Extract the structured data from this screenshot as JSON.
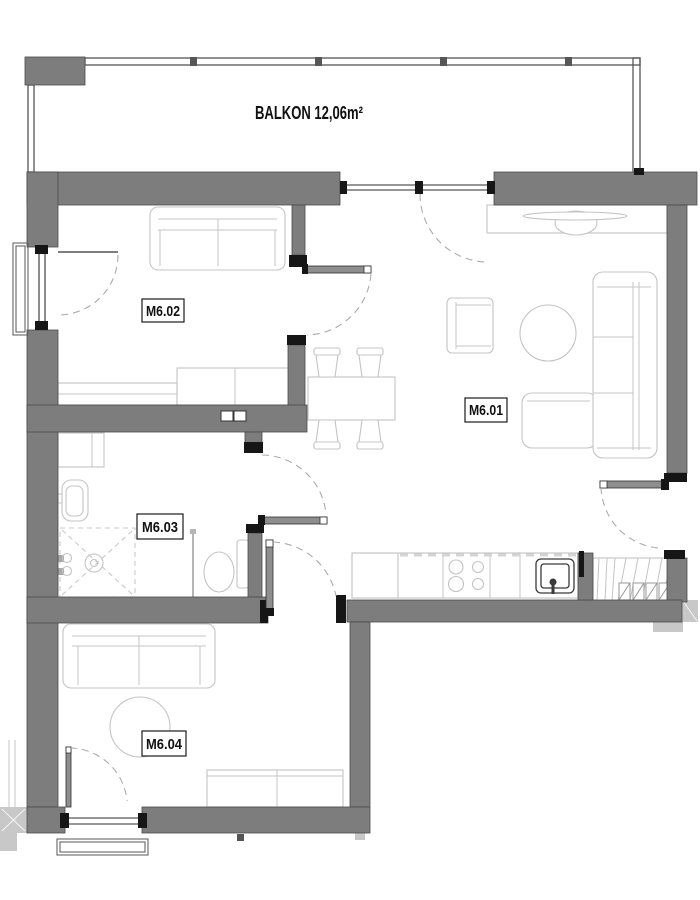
{
  "floorplan": {
    "balcony": {
      "label": "BALKON 12,06m²"
    },
    "rooms": [
      {
        "id": "room-m601",
        "label": "M6.01"
      },
      {
        "id": "room-m602",
        "label": "M6.02"
      },
      {
        "id": "room-m603",
        "label": "M6.03"
      },
      {
        "id": "room-m604",
        "label": "M6.04"
      }
    ],
    "colors": {
      "bg": "#ffffff",
      "wall": "#7d7d7d",
      "wall_outline": "#4b4b4b",
      "wall_dark": "#161616",
      "wall_light": "#c8c8c8",
      "furniture": "#c4c4c4",
      "fixture": "#3a3a3a",
      "door": "#8e8e8e",
      "arc": "#ababab",
      "frame": "#2e2e2e",
      "label": "#111111"
    }
  }
}
